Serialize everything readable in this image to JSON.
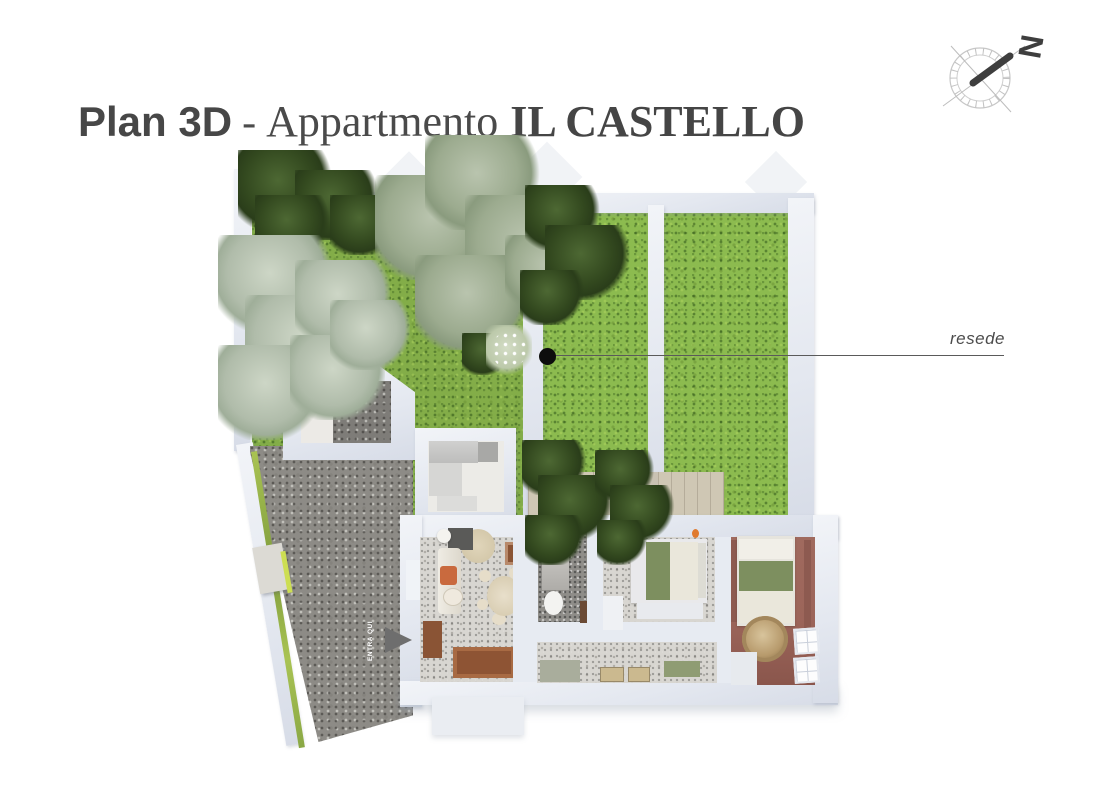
{
  "header": {
    "title_sans": "Plan 3D",
    "title_sep": "-",
    "title_serif": "Appartmento",
    "title_serif_bold": "IL CASTELLO"
  },
  "compass": {
    "letter": "N"
  },
  "annotations": {
    "garden_label": "resede",
    "entrance_label": "ENTRA QUI"
  },
  "palette": {
    "title_color": "#4c4c4c",
    "grass": "#83ad48",
    "grass_bright": "#8cbb4f",
    "gravel": "#8d8b86",
    "wall": "#e4e8f0",
    "terrazzo_floor": "#d8d6d1",
    "bathroom_floor": "#8f8d89",
    "bedroom_floor": "#9c655a",
    "terrace_paving": "#cfc7b4",
    "tree_dark": "#33491f",
    "tree_light": "#b0bcaa",
    "wood_furniture": "#8a5435",
    "bedding_green": "#7d8f5f",
    "marker": "#0d0d0d"
  }
}
